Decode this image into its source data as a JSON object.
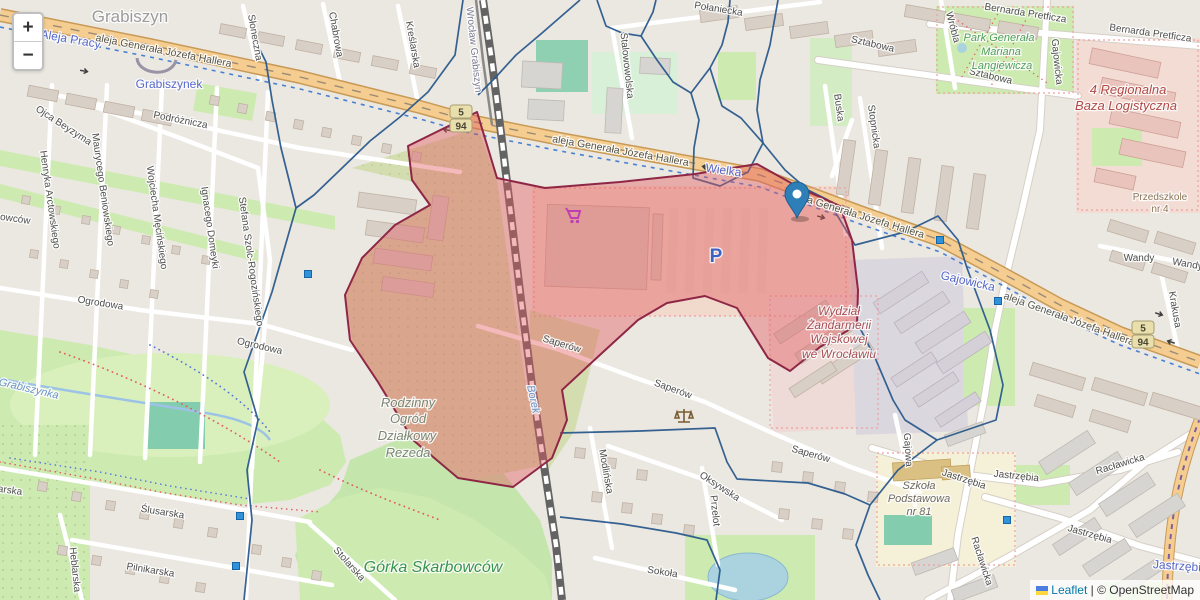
{
  "map": {
    "controls": {
      "zoom_in_label": "+",
      "zoom_out_label": "−"
    },
    "attribution": {
      "flag_icon": "ukraine-flag",
      "leaflet_link": "Leaflet",
      "separator": " | ",
      "copyright_text": "© OpenStreetMap"
    },
    "marker": {
      "x": 797,
      "y": 218,
      "color": "#2e7eb8"
    },
    "highlight_zone": {
      "fill": "#e2595c",
      "fill_opacity": 0.42,
      "stroke": "#8e2746",
      "stroke_width": 2
    },
    "boundary_color": "#2a5a8c",
    "shields": [
      {
        "ref": "5",
        "x": 461,
        "y": 112
      },
      {
        "ref": "94",
        "x": 461,
        "y": 126
      },
      {
        "ref": "5",
        "x": 1143,
        "y": 328
      },
      {
        "ref": "94",
        "x": 1143,
        "y": 342
      }
    ],
    "transit_stops": [
      [
        308,
        274
      ],
      [
        940,
        240
      ],
      [
        998,
        301
      ],
      [
        1007,
        520
      ],
      [
        240,
        516
      ],
      [
        236,
        566
      ]
    ],
    "poi_icons": [
      {
        "name": "supermarket-cart-icon",
        "x": 575,
        "y": 217,
        "color": "#bf3eb4"
      },
      {
        "name": "courthouse-scales-icon",
        "x": 684,
        "y": 416,
        "color": "#7a5c33"
      }
    ],
    "labels": [
      {
        "t": "Grabiszyn",
        "x": 130,
        "y": 22,
        "r": 0,
        "c": "pl"
      },
      {
        "t": "Aleja Pracy",
        "x": 70,
        "y": 43,
        "r": 10,
        "c": "plb"
      },
      {
        "t": "aleja Generała Józefa Hallera",
        "x": 163,
        "y": 54,
        "r": 11,
        "c": "rd"
      },
      {
        "t": "Grabiszynek",
        "x": 169,
        "y": 88,
        "r": 0,
        "c": "plb"
      },
      {
        "t": "Podróżnicza",
        "x": 180,
        "y": 123,
        "r": 11,
        "c": "st"
      },
      {
        "t": "Ojca Beyzyma",
        "x": 62,
        "y": 128,
        "r": 33,
        "c": "st"
      },
      {
        "t": "Słoneczna",
        "x": 252,
        "y": 38,
        "r": 80,
        "c": "st"
      },
      {
        "t": "Chabrowa",
        "x": 333,
        "y": 35,
        "r": 80,
        "c": "st"
      },
      {
        "t": "Kreślarska",
        "x": 410,
        "y": 45,
        "r": 80,
        "c": "st"
      },
      {
        "t": "Wrocław Grabiszyn",
        "x": 471,
        "y": 50,
        "r": 84,
        "c": "sta"
      },
      {
        "t": "Połaniecka",
        "x": 718,
        "y": 12,
        "r": 9,
        "c": "st"
      },
      {
        "t": "Stalowowolska",
        "x": 624,
        "y": 66,
        "r": 84,
        "c": "st"
      },
      {
        "t": "Wielka",
        "x": 723,
        "y": 174,
        "r": 8,
        "c": "plb"
      },
      {
        "t": "aleja Generała Józefa Hallera",
        "x": 620,
        "y": 154,
        "r": 10,
        "c": "rd"
      },
      {
        "t": "aleja Generała Józefa Hallera",
        "x": 857,
        "y": 218,
        "r": 17,
        "c": "rd"
      },
      {
        "t": "aleja Generała Józefa Hallera",
        "x": 1068,
        "y": 322,
        "r": 20,
        "c": "rd"
      },
      {
        "t": "Sztabowa",
        "x": 872,
        "y": 47,
        "r": 13,
        "c": "st"
      },
      {
        "t": "Sztabowa",
        "x": 990,
        "y": 79,
        "r": 13,
        "c": "st"
      },
      {
        "t": "Buska",
        "x": 836,
        "y": 108,
        "r": 82,
        "c": "st"
      },
      {
        "t": "Stopnicka",
        "x": 871,
        "y": 127,
        "r": 82,
        "c": "st"
      },
      {
        "t": "Wróbla",
        "x": 950,
        "y": 28,
        "r": 75,
        "c": "st"
      },
      {
        "t": "Bernarda Pretficza",
        "x": 1025,
        "y": 16,
        "r": 9,
        "c": "st"
      },
      {
        "t": "Bernarda Pretficza",
        "x": 1150,
        "y": 36,
        "r": 8,
        "c": "st"
      },
      {
        "t": "Park Generała",
        "x": 999,
        "y": 41,
        "r": 0,
        "c": "gr"
      },
      {
        "t": "Mariana",
        "x": 1001,
        "y": 55,
        "r": 0,
        "c": "gr"
      },
      {
        "t": "Langiewicza",
        "x": 1002,
        "y": 69,
        "r": 0,
        "c": "gr"
      },
      {
        "t": "4 Regionalna",
        "x": 1128,
        "y": 94,
        "r": 0,
        "c": "rp"
      },
      {
        "t": "Baza Logistyczna",
        "x": 1126,
        "y": 110,
        "r": 0,
        "c": "rp"
      },
      {
        "t": "Gajowicka",
        "x": 1054,
        "y": 62,
        "r": 84,
        "c": "st"
      },
      {
        "t": "Gajowicka",
        "x": 967,
        "y": 285,
        "r": 13,
        "c": "plb"
      },
      {
        "t": "Wandy",
        "x": 1139,
        "y": 261,
        "r": 0,
        "c": "st"
      },
      {
        "t": "Wandy",
        "x": 1187,
        "y": 267,
        "r": 10,
        "c": "st"
      },
      {
        "t": "Krakusa",
        "x": 1172,
        "y": 310,
        "r": 80,
        "c": "st"
      },
      {
        "t": "Przedszkole",
        "x": 1160,
        "y": 200,
        "r": 0,
        "c": "poi"
      },
      {
        "t": "nr 4",
        "x": 1160,
        "y": 212,
        "r": 0,
        "c": "poi"
      },
      {
        "t": "Gajowa",
        "x": 905,
        "y": 450,
        "r": 86,
        "c": "st"
      },
      {
        "t": "Saperów",
        "x": 561,
        "y": 347,
        "r": 17,
        "c": "st"
      },
      {
        "t": "Saperów",
        "x": 672,
        "y": 392,
        "r": 20,
        "c": "st"
      },
      {
        "t": "Saperów",
        "x": 810,
        "y": 457,
        "r": 16,
        "c": "st"
      },
      {
        "t": "Modlińska",
        "x": 603,
        "y": 472,
        "r": 80,
        "c": "st"
      },
      {
        "t": "Oksywska",
        "x": 718,
        "y": 489,
        "r": 33,
        "c": "st"
      },
      {
        "t": "Przelot",
        "x": 712,
        "y": 511,
        "r": 84,
        "c": "st"
      },
      {
        "t": "Sokoła",
        "x": 662,
        "y": 575,
        "r": 9,
        "c": "st"
      },
      {
        "t": "Rodzinny",
        "x": 408,
        "y": 407,
        "r": 0,
        "c": "al"
      },
      {
        "t": "Ogród",
        "x": 408,
        "y": 423,
        "r": 0,
        "c": "al"
      },
      {
        "t": "Działkowy",
        "x": 407,
        "y": 440,
        "r": 0,
        "c": "al"
      },
      {
        "t": "Rezeda",
        "x": 408,
        "y": 457,
        "r": 0,
        "c": "al"
      },
      {
        "t": "Górka Skarbowców",
        "x": 433,
        "y": 572,
        "r": 0,
        "c": "gr2"
      },
      {
        "t": "Wydział",
        "x": 839,
        "y": 315,
        "r": 0,
        "c": "rp2"
      },
      {
        "t": "Żandarmerii",
        "x": 839,
        "y": 329,
        "r": 0,
        "c": "rp2"
      },
      {
        "t": "Wojskowej",
        "x": 839,
        "y": 343,
        "r": 0,
        "c": "rp2"
      },
      {
        "t": "we Wrocławiu",
        "x": 839,
        "y": 358,
        "r": 0,
        "c": "rp2"
      },
      {
        "t": "Szkoła",
        "x": 919,
        "y": 489,
        "r": 0,
        "c": "sch"
      },
      {
        "t": "Podstawowa",
        "x": 919,
        "y": 502,
        "r": 0,
        "c": "sch"
      },
      {
        "t": "nr 81",
        "x": 919,
        "y": 515,
        "r": 0,
        "c": "sch"
      },
      {
        "t": "Ślusarska",
        "x": 162,
        "y": 515,
        "r": 9,
        "c": "st"
      },
      {
        "t": "Pilnikarska",
        "x": 150,
        "y": 573,
        "r": 9,
        "c": "st"
      },
      {
        "t": "Heblarska",
        "x": 72,
        "y": 570,
        "r": 84,
        "c": "st"
      },
      {
        "t": "Stolarska",
        "x": 347,
        "y": 566,
        "r": 48,
        "c": "st"
      },
      {
        "t": "Ślusarska",
        "x": 0,
        "y": 492,
        "r": 8,
        "c": "st"
      },
      {
        "t": "Skarbowców",
        "x": 2,
        "y": 220,
        "r": 8,
        "c": "st"
      },
      {
        "t": "Grabiszynka",
        "x": 28,
        "y": 392,
        "r": 13,
        "c": "wa"
      },
      {
        "t": "Borek",
        "x": 530,
        "y": 400,
        "r": 78,
        "c": "wa"
      },
      {
        "t": "Henryka Arctowskiego",
        "x": 47,
        "y": 200,
        "r": 82,
        "c": "st"
      },
      {
        "t": "Maurycego Beniowskiego",
        "x": 100,
        "y": 190,
        "r": 82,
        "c": "st"
      },
      {
        "t": "Wojciecha Męcińskiego",
        "x": 154,
        "y": 218,
        "r": 82,
        "c": "st"
      },
      {
        "t": "Ignacego Domeyki",
        "x": 207,
        "y": 228,
        "r": 82,
        "c": "st"
      },
      {
        "t": "Stefana Szolc-Rogozińskiego",
        "x": 248,
        "y": 262,
        "r": 82,
        "c": "st"
      },
      {
        "t": "Ogrodowa",
        "x": 100,
        "y": 306,
        "r": 9,
        "c": "st"
      },
      {
        "t": "Ogrodowa",
        "x": 259,
        "y": 349,
        "r": 13,
        "c": "st"
      },
      {
        "t": "Jastrzębia",
        "x": 963,
        "y": 482,
        "r": 18,
        "c": "st"
      },
      {
        "t": "Jastrzębia",
        "x": 1016,
        "y": 479,
        "r": 6,
        "c": "st"
      },
      {
        "t": "Jastrzębia",
        "x": 1089,
        "y": 537,
        "r": 16,
        "c": "st"
      },
      {
        "t": "Racławicka",
        "x": 1121,
        "y": 467,
        "r": -17,
        "c": "st"
      },
      {
        "t": "Racławicka",
        "x": 979,
        "y": 562,
        "r": 72,
        "c": "st"
      },
      {
        "t": "Jastrzębia",
        "x": 1180,
        "y": 570,
        "r": 4,
        "c": "plb"
      },
      {
        "t": "P",
        "x": 716,
        "y": 262,
        "r": 0,
        "c": "pk"
      }
    ]
  }
}
